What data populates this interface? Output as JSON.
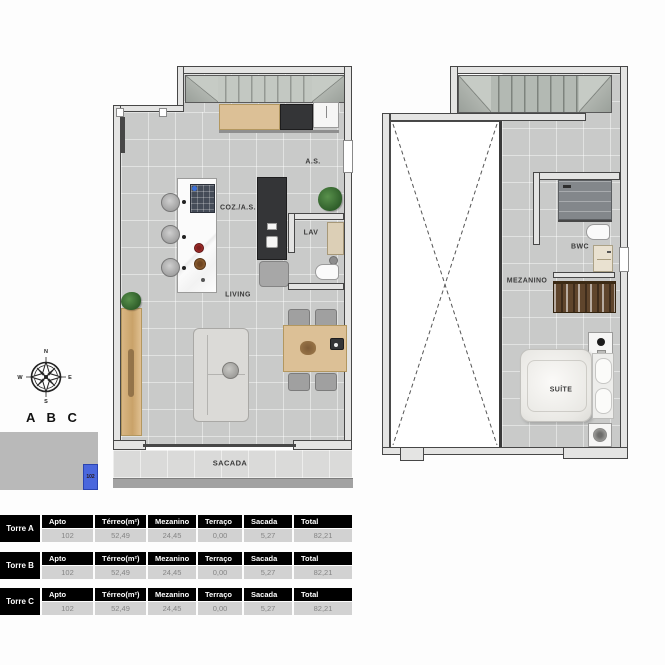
{
  "unit": {
    "code": "102",
    "block_letters": "A B C"
  },
  "compass": {
    "n": "N",
    "e": "E",
    "s": "S",
    "w": "W"
  },
  "floorplans": {
    "ground": {
      "labels": {
        "as": "A.S.",
        "coz_as": "COZ./A.S.",
        "lav": "LAV",
        "living": "LIVING",
        "sacada": "SACADA"
      }
    },
    "upper": {
      "labels": {
        "mezanino": "MEZANINO",
        "bwc": "BWC",
        "suite": "SUÍTE"
      }
    }
  },
  "area_tables": [
    {
      "tower": "Torre A",
      "headers": [
        "Apto",
        "Térreo(m²)",
        "Mezanino",
        "Terraço",
        "Sacada",
        "Total"
      ],
      "row": [
        "102",
        "52,49",
        "24,45",
        "0,00",
        "5,27",
        "82,21"
      ]
    },
    {
      "tower": "Torre B",
      "headers": [
        "Apto",
        "Térreo(m²)",
        "Mezanino",
        "Terraço",
        "Sacada",
        "Total"
      ],
      "row": [
        "102",
        "52,49",
        "24,45",
        "0,00",
        "5,27",
        "82,21"
      ]
    },
    {
      "tower": "Torre C",
      "headers": [
        "Apto",
        "Térreo(m²)",
        "Mezanino",
        "Terraço",
        "Sacada",
        "Total"
      ],
      "row": [
        "102",
        "52,49",
        "24,45",
        "0,00",
        "5,27",
        "82,21"
      ]
    }
  ],
  "colors": {
    "accent_blue": "#4a67dd",
    "wall_outline": "#474747",
    "floor": "#c9cac9",
    "wood": "#dcc096",
    "dark_counter": "#343537",
    "table_header_bg": "#000000",
    "table_row_bg": "#d2d2d2"
  }
}
